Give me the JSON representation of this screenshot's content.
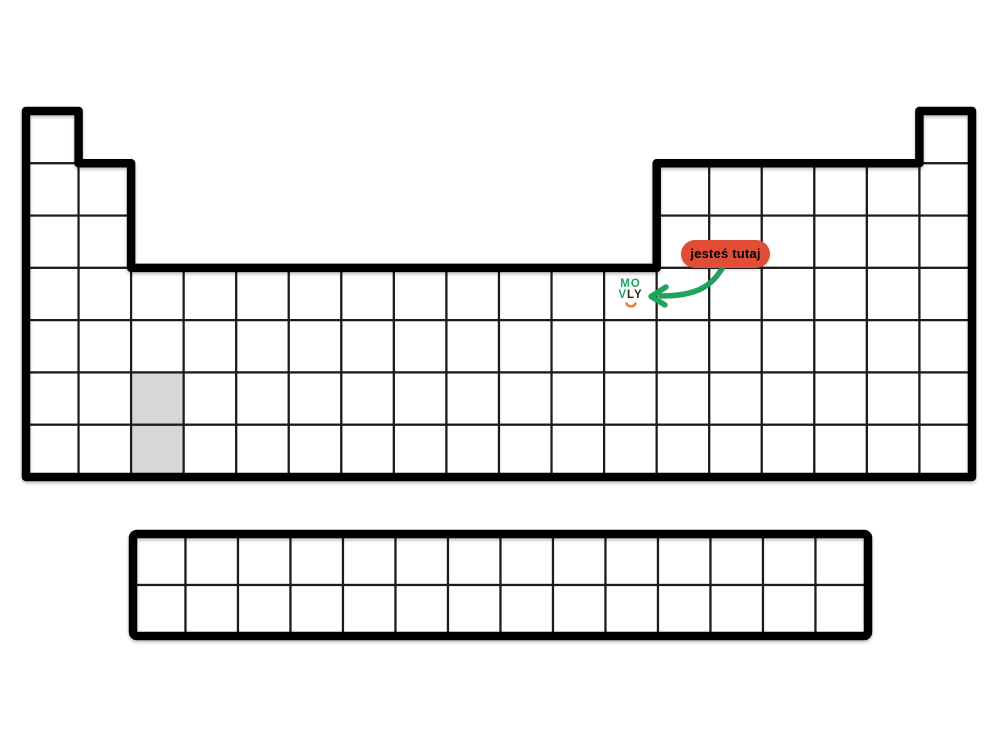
{
  "canvas": {
    "width": 1000,
    "height": 750,
    "background": "#ffffff"
  },
  "marker": {
    "badge_label": "jesteś tutaj",
    "badge_bg": "#e24d38",
    "badge_text_color": "#ffffff",
    "arrow_color": "#22a35c"
  },
  "logo": {
    "top": "MO",
    "bottom_green": "V",
    "bottom_dark": "LY",
    "green": "#22a35c",
    "dark": "#32281d",
    "smile_color": "#ef7f38"
  },
  "periodic_table": {
    "line_color": "#000000",
    "thin_line_color": "#1b1b1b",
    "cell_fill": "#ffffff",
    "gray_fill": "#d7d7d7",
    "cols": 18,
    "rows": 7,
    "origin": {
      "x": 26,
      "y": 111
    },
    "cell": {
      "w": 52.556,
      "h": 52.29
    },
    "row_spans": [
      [
        [
          0,
          1
        ],
        [
          17,
          18
        ]
      ],
      [
        [
          0,
          2
        ],
        [
          12,
          18
        ]
      ],
      [
        [
          0,
          2
        ],
        [
          12,
          18
        ]
      ],
      [
        [
          0,
          18
        ]
      ],
      [
        [
          0,
          18
        ]
      ],
      [
        [
          0,
          18
        ]
      ],
      [
        [
          0,
          18
        ]
      ]
    ],
    "gray_cells": [
      {
        "col": 2,
        "row": 5
      },
      {
        "col": 2,
        "row": 6
      }
    ],
    "logo_cell": {
      "col": 11,
      "row": 3
    },
    "outline": [
      [
        26,
        111
      ],
      [
        78.6,
        111
      ],
      [
        78.6,
        163.3
      ],
      [
        131.1,
        163.3
      ],
      [
        131.1,
        267.9
      ],
      [
        656.7,
        267.9
      ],
      [
        656.7,
        163.3
      ],
      [
        919.4,
        163.3
      ],
      [
        919.4,
        111
      ],
      [
        972,
        111
      ],
      [
        972,
        477
      ],
      [
        26,
        477
      ]
    ]
  },
  "f_block": {
    "origin": {
      "x": 133,
      "y": 534
    },
    "cols": 14,
    "rows": 2,
    "cell": {
      "w": 52.5,
      "h": 51
    }
  },
  "arrow": {
    "path": "M 724 265 C 713 286 697 296 661 296",
    "head_path": "M 666 287 L 651 296.5 L 665 305"
  }
}
